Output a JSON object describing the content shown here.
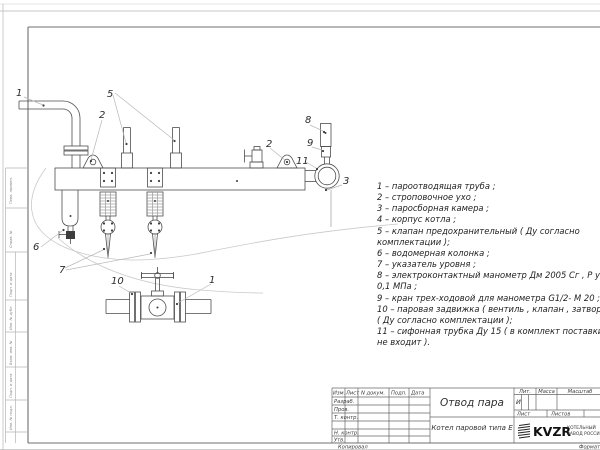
{
  "drawing": {
    "callouts": [
      {
        "n": "1"
      },
      {
        "n": "2"
      },
      {
        "n": "5"
      },
      {
        "n": "2"
      },
      {
        "n": "8"
      },
      {
        "n": "9"
      },
      {
        "n": "11"
      },
      {
        "n": "3"
      },
      {
        "n": "6"
      },
      {
        "n": "7"
      },
      {
        "n": "10"
      },
      {
        "n": "1"
      }
    ]
  },
  "parts_list": {
    "lines": [
      "1 –  пароотводящая труба ;",
      "2 –  строповочное ухо ;",
      "3 –  паросборная камера ;",
      "4 –  корпус котла ;",
      "5 –  клапан предохранительный  ( Ду согласно",
      "комплектации );",
      "6 –  водомерная колонка ;",
      "7 – указатель уровня ;",
      "8 – электроконтактный манометр  Дм 2005 Сг ,  Р у",
      "0,1  МПа ;",
      "9 –  кран трех-ходовой для манометра  G1/2- М 20 ;",
      "10 –  паровая задвижка  ( вентиль ,  клапан ,  затвор )",
      "( Ду согласно комплектации );",
      "11 –  сифонная трубка Ду 15 ( в комплект поставки",
      "не входит )."
    ]
  },
  "margin": {
    "stamps": [
      "Перв. примен.",
      "Справ. №",
      "Подп. и дата",
      "Инв. № дубл.",
      "Взам. инв. №",
      "Подп. и дата",
      "Инв. № подл."
    ]
  },
  "title_block": {
    "header": {
      "izm": "Изм.",
      "list": "Лист",
      "doc": "N докум.",
      "sign": "Подп.",
      "date": "Дата"
    },
    "rows": {
      "razrab": "Разраб.",
      "prov": "Пров.",
      "tkontr": "Т. контр.",
      "nkontr": "Н. контр.",
      "utv": "Утв."
    },
    "title": "Отвод пара",
    "subtitle": "Котел паровой типа Е",
    "lit_label": "Лит.",
    "mass_label": "Масса",
    "scale_label": "Масштаб",
    "lit_value": "И",
    "sheet_label": "Лист",
    "sheets_label": "Листов",
    "logo_text": "KVZR",
    "logo_caption_line1": "КОТЕЛЬНЫЙ",
    "logo_caption_line2": "ЗАВОД РОССИИ"
  },
  "footer": {
    "copied_label": "Копировал",
    "format_label": "Формат"
  }
}
